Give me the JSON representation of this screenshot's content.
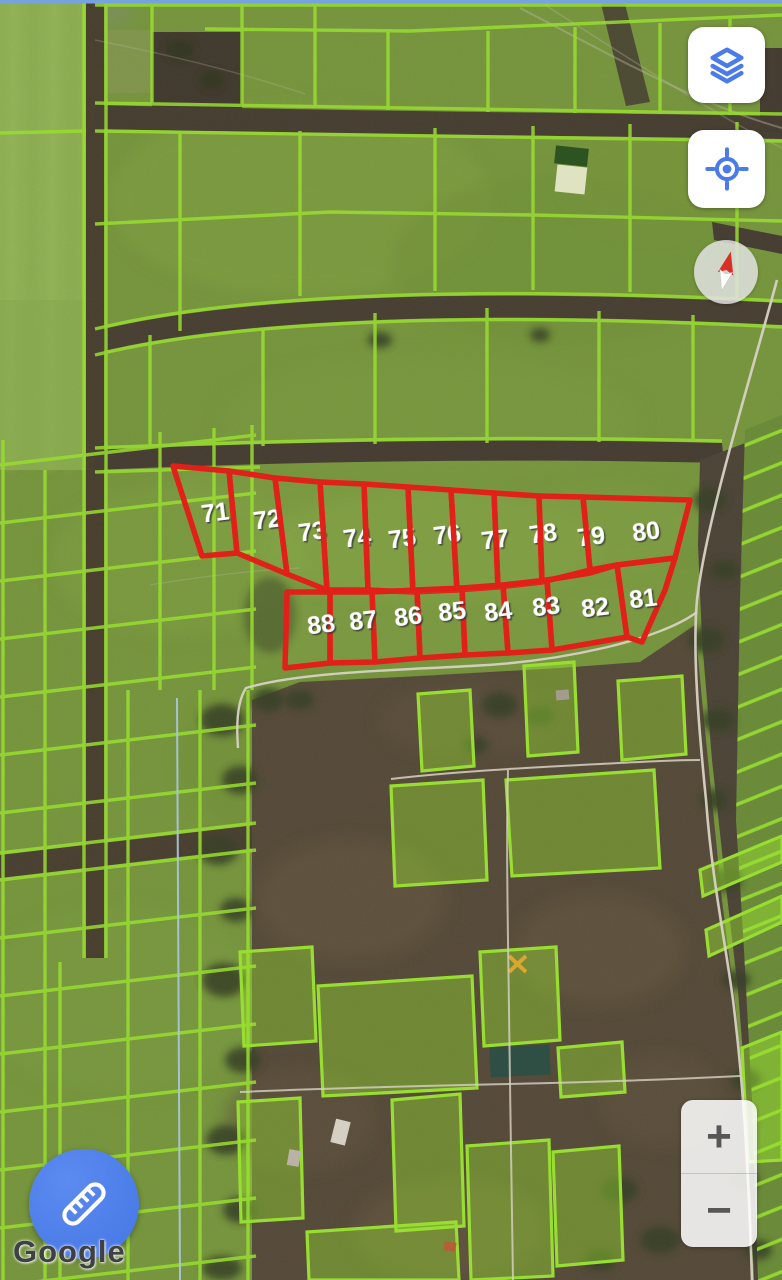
{
  "map": {
    "attribution": "Google",
    "colors": {
      "parcel_outline": "#e1201a",
      "parcel_label": "#ffffff",
      "cadastral_line": "#98dd31",
      "accent_blue": "#4b7be8"
    },
    "numbered_parcels": [
      {
        "number": "71",
        "points": "173,466 229,471 237,553 202,556",
        "lx": 215,
        "ly": 512
      },
      {
        "number": "72",
        "points": "229,471 275,478 287,574 237,553",
        "lx": 267,
        "ly": 519
      },
      {
        "number": "73",
        "points": "275,478 320,482 327,590 287,574",
        "lx": 312,
        "ly": 531
      },
      {
        "number": "74",
        "points": "320,482 364,484 368,590 327,590",
        "lx": 357,
        "ly": 537
      },
      {
        "number": "75",
        "points": "364,484 408,487 413,592 368,590",
        "lx": 402,
        "ly": 538
      },
      {
        "number": "76",
        "points": "408,487 451,490 457,590 413,592",
        "lx": 447,
        "ly": 534
      },
      {
        "number": "77",
        "points": "451,490 494,493 498,587 457,590",
        "lx": 495,
        "ly": 539
      },
      {
        "number": "78",
        "points": "494,493 539,496 542,582 498,587",
        "lx": 543,
        "ly": 533
      },
      {
        "number": "79",
        "points": "539,496 583,497 590,570 542,582",
        "lx": 591,
        "ly": 536
      },
      {
        "number": "80",
        "points": "583,497 690,500 675,558 617,565 590,570",
        "lx": 646,
        "ly": 531
      },
      {
        "number": "81",
        "points": "617,565 675,558 665,590 642,642 627,637",
        "lx": 643,
        "ly": 598
      },
      {
        "number": "82",
        "points": "547,580 590,573 617,565 627,637 552,650",
        "lx": 595,
        "ly": 607
      },
      {
        "number": "83",
        "points": "503,585 547,580 552,650 508,653",
        "lx": 546,
        "ly": 606
      },
      {
        "number": "84",
        "points": "462,588 503,585 508,653 465,655",
        "lx": 498,
        "ly": 611
      },
      {
        "number": "85",
        "points": "417,590 462,588 465,655 420,658",
        "lx": 452,
        "ly": 611
      },
      {
        "number": "86",
        "points": "372,592 417,590 420,658 375,662",
        "lx": 408,
        "ly": 616
      },
      {
        "number": "87",
        "points": "330,592 372,592 375,662 330,663",
        "lx": 363,
        "ly": 620
      },
      {
        "number": "88",
        "points": "287,592 330,592 330,663 285,668",
        "lx": 321,
        "ly": 624
      }
    ]
  },
  "controls": {
    "zoom_in": "+",
    "zoom_out": "−"
  }
}
